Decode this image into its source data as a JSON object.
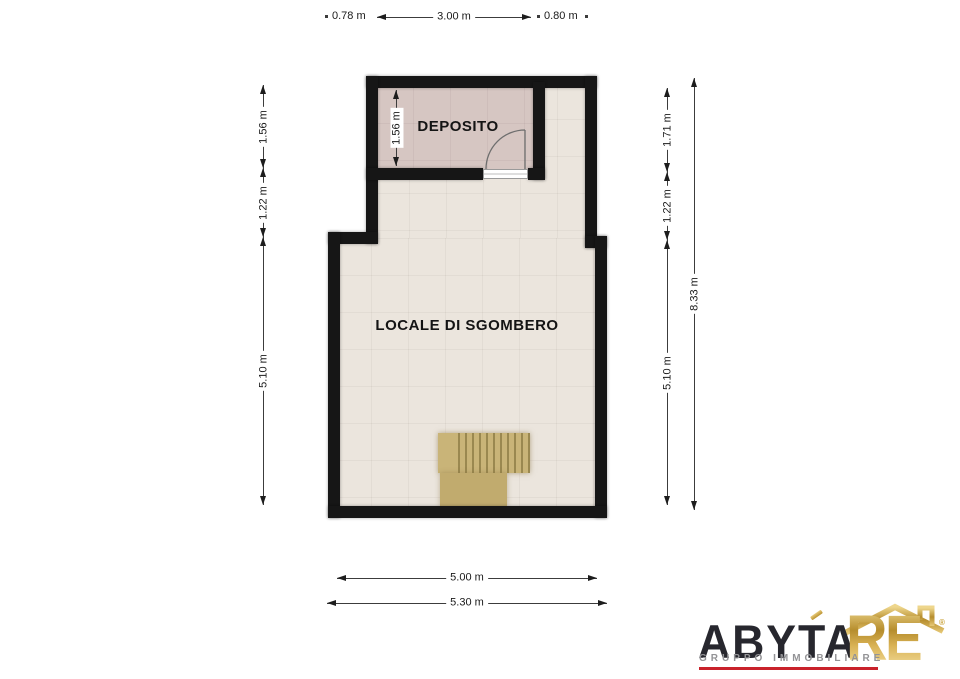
{
  "floorplan": {
    "rooms": [
      {
        "label": "DEPOSITO",
        "floor_color": "#d6c6c2"
      },
      {
        "label": "LOCALE DI SGOMBERO",
        "floor_color": "#ebe5dd"
      }
    ],
    "wall_color": "#161616",
    "stair_color": "#c9b478",
    "dimensions": {
      "top_left_offset": "0.78 m",
      "top_width": "3.00 m",
      "top_right_offset": "0.80 m",
      "left": [
        "1.56 m",
        "1.22 m",
        "5.10 m"
      ],
      "right_inner": [
        "1.71 m",
        "1.22 m",
        "5.10 m"
      ],
      "right_total": "8.33 m",
      "bottom_inner": "5.00 m",
      "bottom_total": "5.30 m",
      "deposito_height": "1.56 m"
    }
  },
  "logo": {
    "brand_dark": "ABYTA",
    "brand_gold": "RE",
    "registered": "®",
    "tagline": "GRUPPO IMMOBILIARE",
    "colors": {
      "dark": "#27272e",
      "gold": "#c9a137",
      "red": "#c9222b",
      "gray": "#939396"
    }
  }
}
